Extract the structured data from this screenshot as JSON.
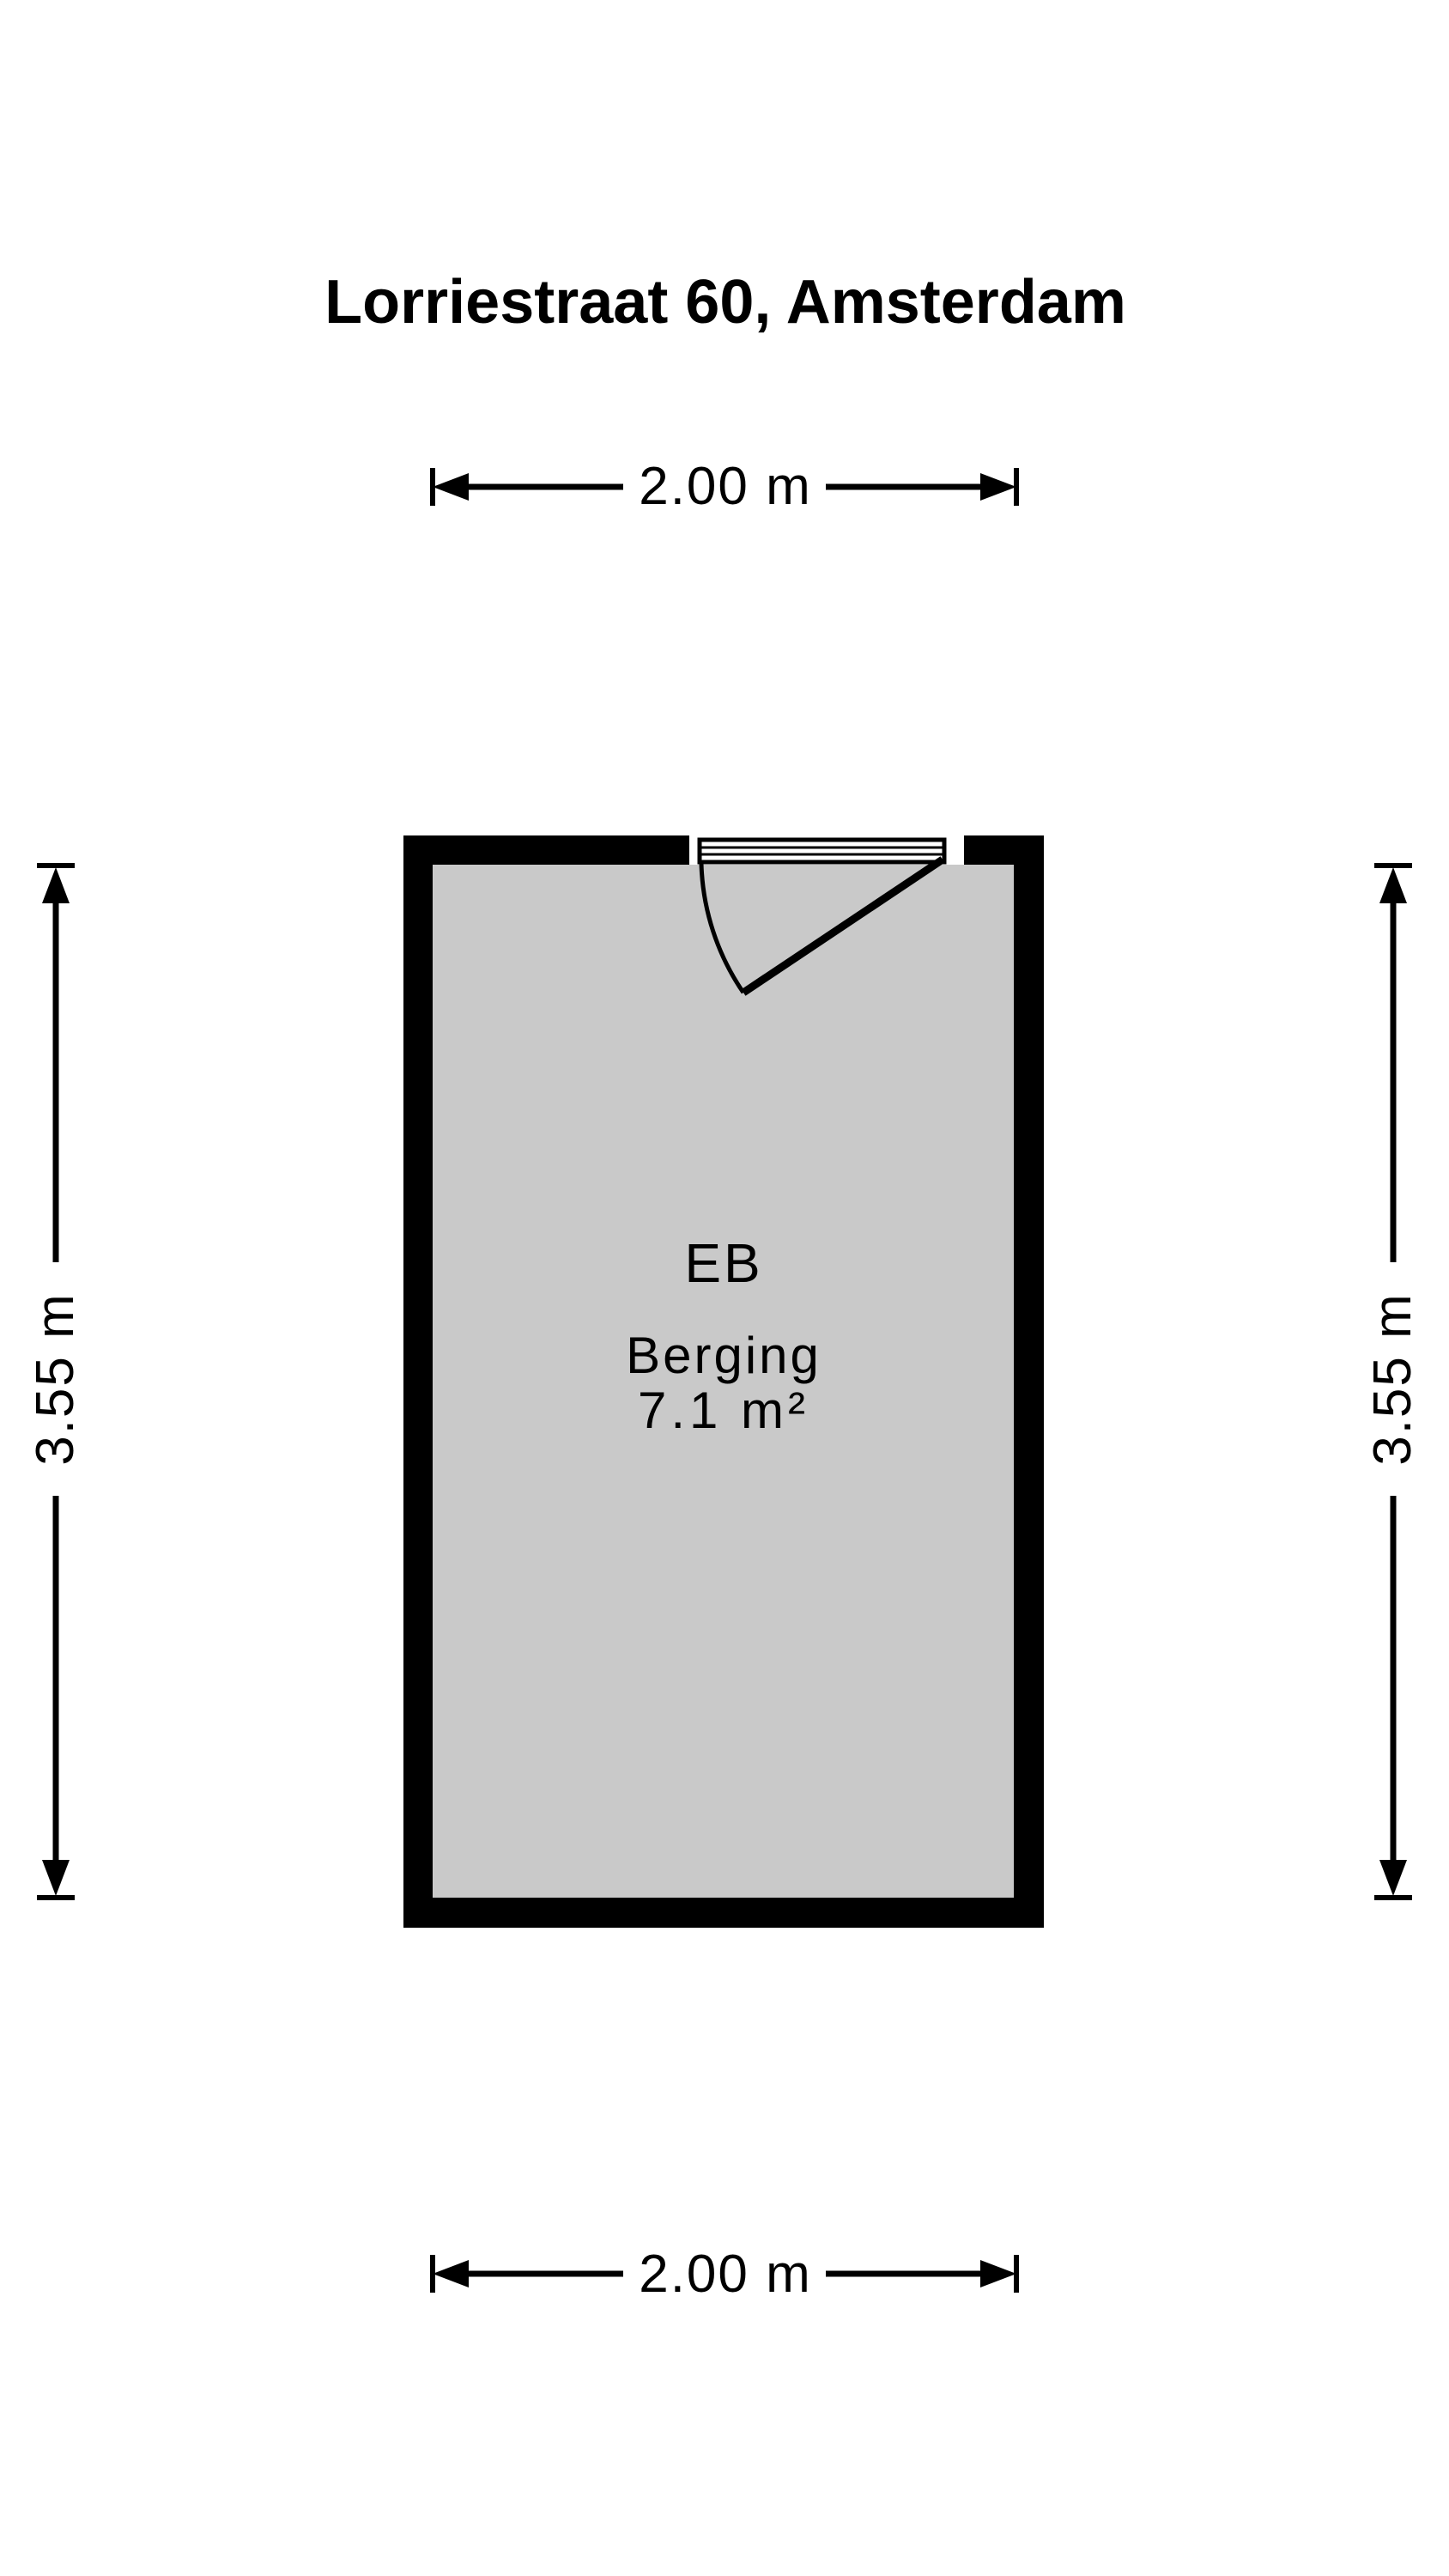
{
  "title": "Lorriestraat 60, Amsterdam",
  "room": {
    "code": "EB",
    "name": "Berging",
    "area": "7.1 m²"
  },
  "dimensions": {
    "width_top": "2.00 m",
    "width_bottom": "2.00 m",
    "height_left": "3.55 m",
    "height_right": "3.55 m"
  },
  "colors": {
    "wall": "#000000",
    "floor": "#c9c9c9",
    "background": "#ffffff",
    "line": "#000000"
  }
}
